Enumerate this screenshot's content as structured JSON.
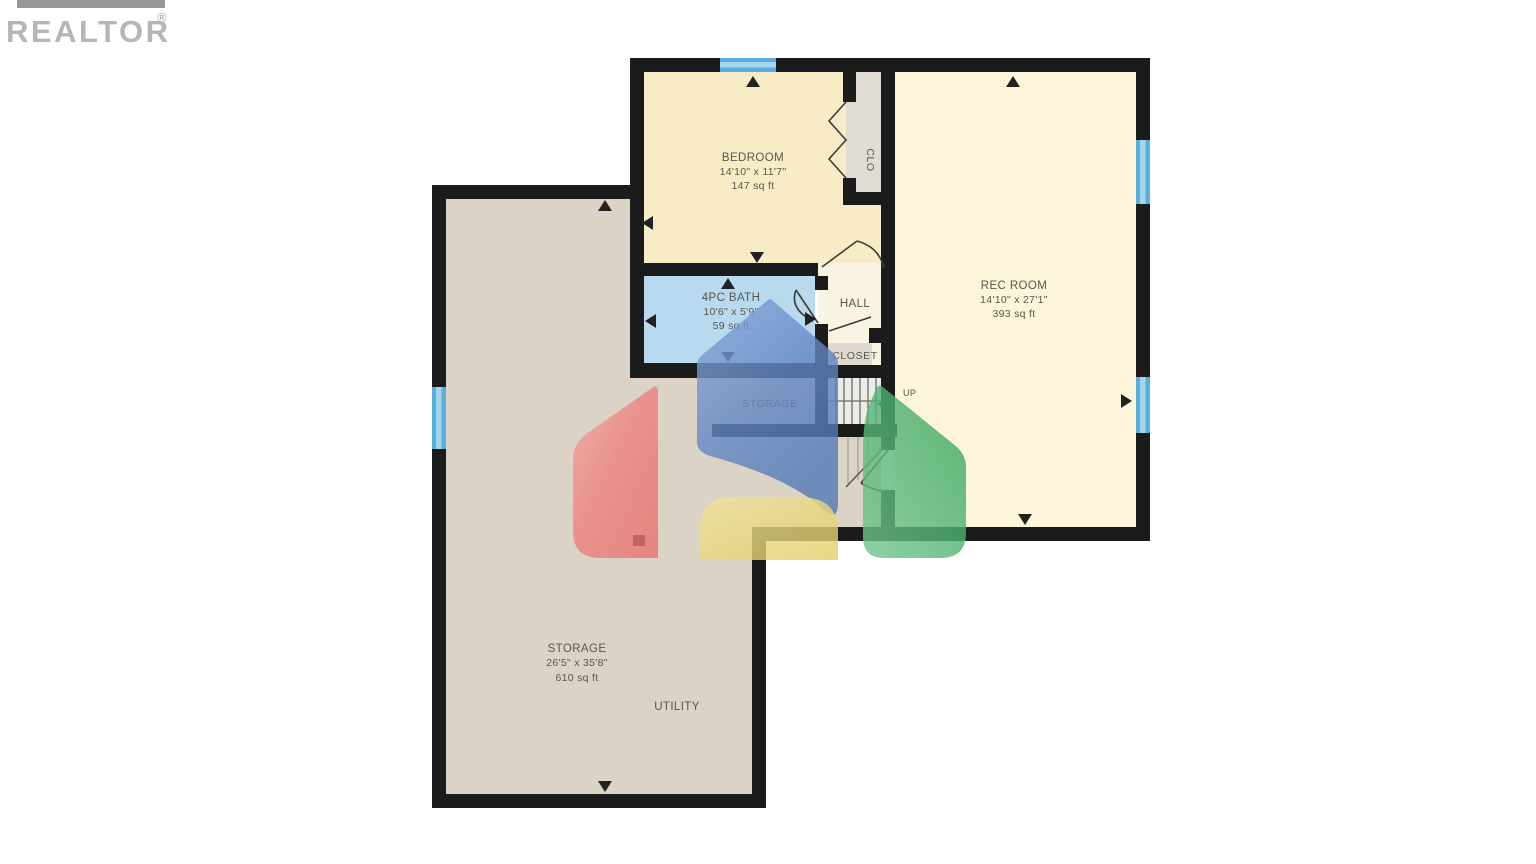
{
  "header": {
    "brand": "REALTOR",
    "registered": "®"
  },
  "plan": {
    "bedroom": {
      "name": "BEDROOM",
      "dims": "14'10\" x 11'7\"",
      "area": "147 sq ft"
    },
    "clo": {
      "name": "CLO"
    },
    "rec_room": {
      "name": "REC ROOM",
      "dims": "14'10\" x 27'1\"",
      "area": "393 sq ft"
    },
    "bath": {
      "name": "4PC BATH",
      "dims": "10'6\" x 5'9\"",
      "area": "59 sq ft"
    },
    "hall": {
      "name": "HALL"
    },
    "closet": {
      "name": "CLOSET"
    },
    "under_stair_storage": {
      "name": "STORAGE"
    },
    "stairs": {
      "direction": "UP"
    },
    "storage": {
      "name": "STORAGE",
      "dims": "26'5\" x 35'8\"",
      "area": "610 sq ft"
    },
    "utility": {
      "name": "UTILITY"
    }
  },
  "colors": {
    "wall": "#1b1b1b",
    "bedroom_fill": "#f8ecc6",
    "rec_room_fill": "#fdf5da",
    "bath_fill": "#b9d9ef",
    "hall_fill": "#f8f3e2",
    "closet_fill": "#dfd9cf",
    "storage_fill": "#dbd4c6",
    "window_blue": "#58aedd",
    "label_text": "#57564e",
    "logo_red": "#ec7e7e",
    "logo_blue": "#5c82c0",
    "logo_yellow": "#e8d478",
    "logo_green": "#46ad68",
    "brand_gray": "#b6b6b9"
  }
}
